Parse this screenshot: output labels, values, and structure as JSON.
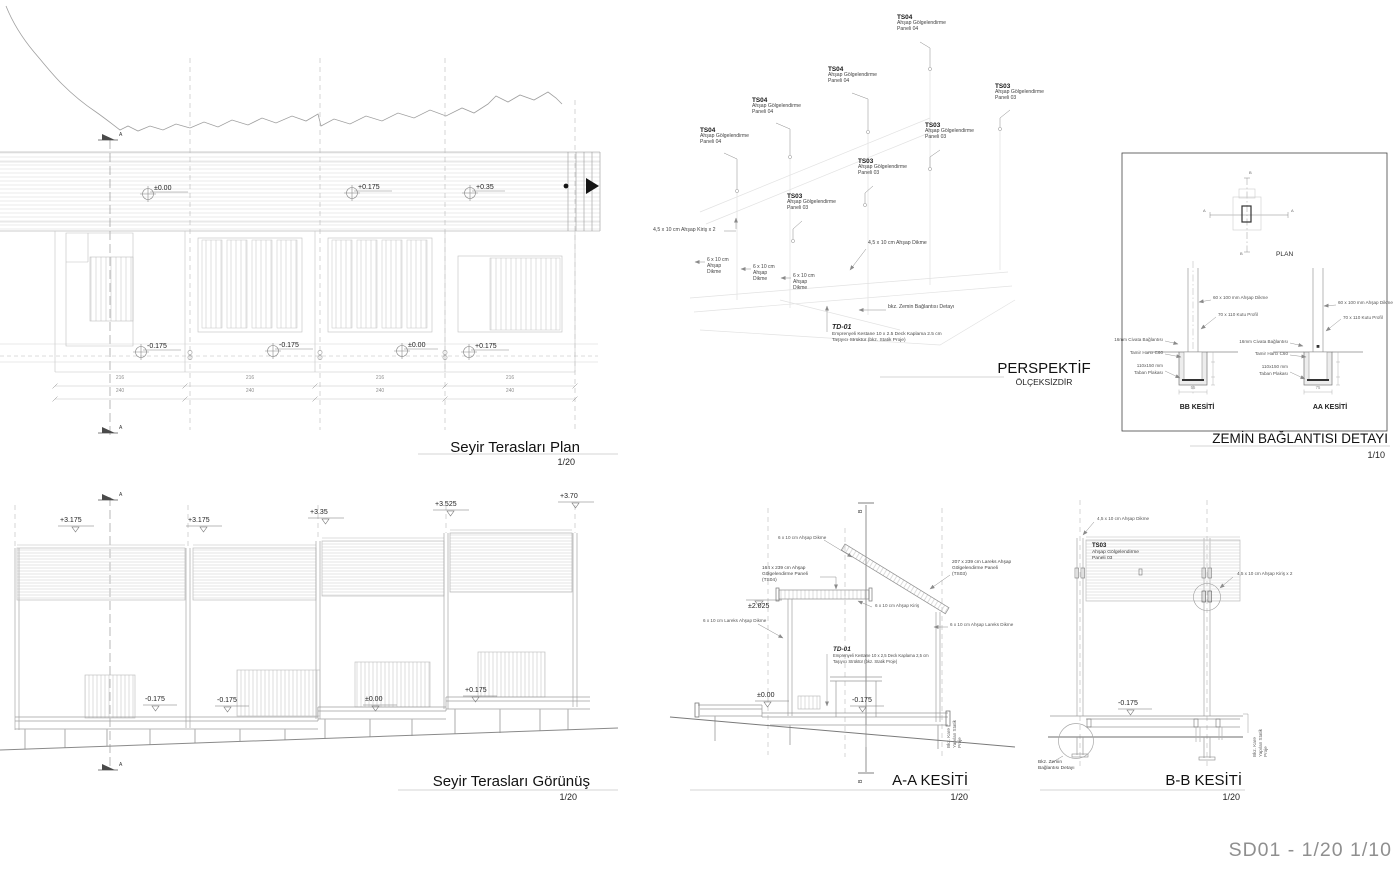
{
  "sheet": {
    "code_label": "SD01 -  1/20  1/10"
  },
  "plan": {
    "title": "Seyir Terasları Plan",
    "scale": "1/20",
    "section_marker": "A",
    "levels_top": [
      "±0.00",
      "+0.175",
      "+0.35"
    ],
    "levels_bottom": [
      "-0.175",
      "-0.175",
      "±0.00",
      "+0.175"
    ],
    "dims_upper": [
      "216",
      "216",
      "216",
      "216"
    ],
    "dims_lower": [
      "240",
      "240",
      "240",
      "240"
    ]
  },
  "elevation": {
    "title": "Seyir Terasları Görünüş",
    "scale": "1/20",
    "section_marker": "A",
    "levels_top": [
      "+3.175",
      "+3.175",
      "+3.35",
      "+3.525",
      "+3.70"
    ],
    "levels_bottom": [
      "-0.175",
      "-0.175",
      "±0.00",
      "+0.175"
    ]
  },
  "perspective": {
    "title": "PERSPEKTİF",
    "subtitle": "ÖLÇEKSİZDİR",
    "ts04": {
      "code": "TS04",
      "line1": "Ahşap Gölgelendirme",
      "line2": "Paneli 04"
    },
    "ts03": {
      "code": "TS03",
      "line1": "Ahşap Gölgelendirme",
      "line2": "Paneli 03"
    },
    "kiris2": "4,5 x 10 cm Ahşap Kiriş x 2",
    "dikme45": "4,5 x 10 cm Ahşap Dikme",
    "dikme610": {
      "line1": "6 x 10 cm",
      "line2": "Ahşap",
      "line3": "Dikme"
    },
    "bkz_zemin": "bkz. Zemin Bağlantısı Detayı",
    "td01": {
      "code": "TD-01",
      "line1": "Emprenyeli Kestane 10 x 2.5 Deck Kaplama 2.5 cm",
      "line2": "Taşıyıcı Strüktür (bkz. Statik Proje)"
    }
  },
  "detail": {
    "title": "ZEMİN BAĞLANTISI DETAYI",
    "scale": "1/10",
    "plan_label": "PLAN",
    "axis_a": "A",
    "axis_b": "B",
    "bb_label": "BB KESİTİ",
    "aa_label": "AA KESİTİ",
    "ann_dikme": "60 x 100 mm Ahşap Dikme",
    "ann_profil": "70 x 110 Kutu Profil",
    "ann_civata": "16mm Civata Bağlantısı",
    "ann_harc": "Tamir Harcı C60",
    "ann_plaka1": "110x150 mm",
    "ann_plaka2": "Taban Plakası",
    "dim_bb": "55",
    "dim_aa": "75"
  },
  "section_aa": {
    "title": "A-A KESİTİ",
    "scale": "1/20",
    "marker": "B",
    "ann_dikme_top": "6 x 10 cm Ahşap Dikme",
    "panel_ts04": {
      "line1": "164 x 239 cm Ahşap",
      "line2": "Gölgelendirme Paneli",
      "line3": "(TS04)"
    },
    "panel_ts03": {
      "line1": "207 x 239 cm Lareks  Ahşap",
      "line2": "Gölgelendirme Paneli",
      "line3": "(TS03)"
    },
    "level_2025": "±2.025",
    "ann_kiris": "6 x 10 cm Ahşap Kiriş",
    "ann_lareks_left": "6 x 10 cm Lareks  Ahşap Dikme",
    "ann_lareks_right": "6 x 10 cm Ahşap Lareks Dikme",
    "td01": {
      "code": "TD-01",
      "line1": "Emprenyeli Kestane 10 x 2,5 Deck Kaplama 2,5 cm",
      "line2": "Taşıyıcı Strüktür (bkz. Statik Proje)"
    },
    "level_000": "±0.00",
    "level_0175": "-0.175",
    "note_vertical": {
      "line1": "Bkz. Kare",
      "line2": "Yapılan Statik",
      "line3": "Proje"
    }
  },
  "section_bb": {
    "title": "B-B KESİTİ",
    "scale": "1/20",
    "ann_dikme": "4,5 x 10 cm Ahşap Dikme",
    "ts03": {
      "code": "TS03",
      "line1": "Ahşap Gölgelendirme",
      "line2": "Paneli 03"
    },
    "ann_kiris": "4,5 x 10 cm Ahşap Kiriş x 2",
    "level_0175": "-0.175",
    "bkz_detail": {
      "line1": "Bkz. Zemin",
      "line2": "Bağlantısı Detayı"
    },
    "note_vertical": {
      "line1": "Bkz. Kare",
      "line2": "Yapılan Statik",
      "line3": "Proje"
    }
  }
}
